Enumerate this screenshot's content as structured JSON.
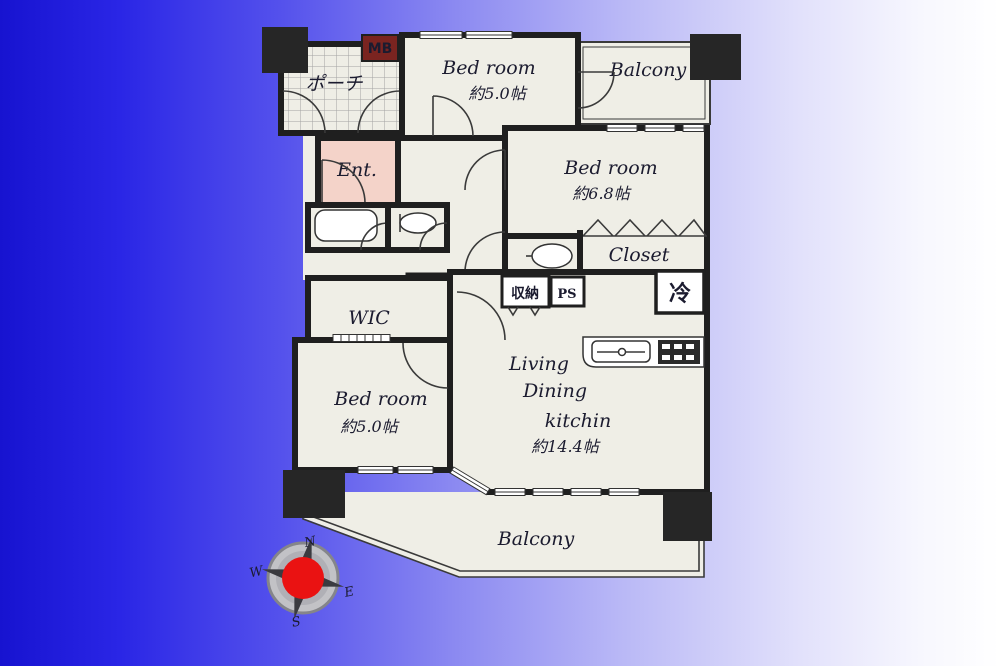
{
  "scene": {
    "background_left_color": "#1713d0",
    "background_right_color": "#ffffff"
  },
  "floorplan": {
    "colors": {
      "wall": "#1f1f1f",
      "floor": "#efeee6",
      "entrance_floor": "#f4d3c9",
      "meter_box_bg": "#7a2420",
      "compass_center": "#ea1212"
    },
    "rooms": {
      "bedroom_top": {
        "name": "Bed room",
        "size": "約5.0帖"
      },
      "bedroom_right": {
        "name": "Bed room",
        "size": "約6.8帖"
      },
      "bedroom_bottom": {
        "name": "Bed room",
        "size": "約5.0帖"
      },
      "ldk": {
        "line1": "Living",
        "line2": "Dining",
        "line3": "kitchin",
        "size": "約14.4帖"
      },
      "balcony_top": "Balcony",
      "balcony_bottom": "Balcony",
      "closet": "Closet",
      "wic": "WIC",
      "entrance": "Ent.",
      "porch": "ポーチ"
    },
    "labels": {
      "meter_box": "MB",
      "storage": "収納",
      "pipe_space": "PS",
      "refrigerator": "冷"
    },
    "compass": {
      "n": "N",
      "e": "E",
      "s": "S",
      "w": "W"
    }
  }
}
